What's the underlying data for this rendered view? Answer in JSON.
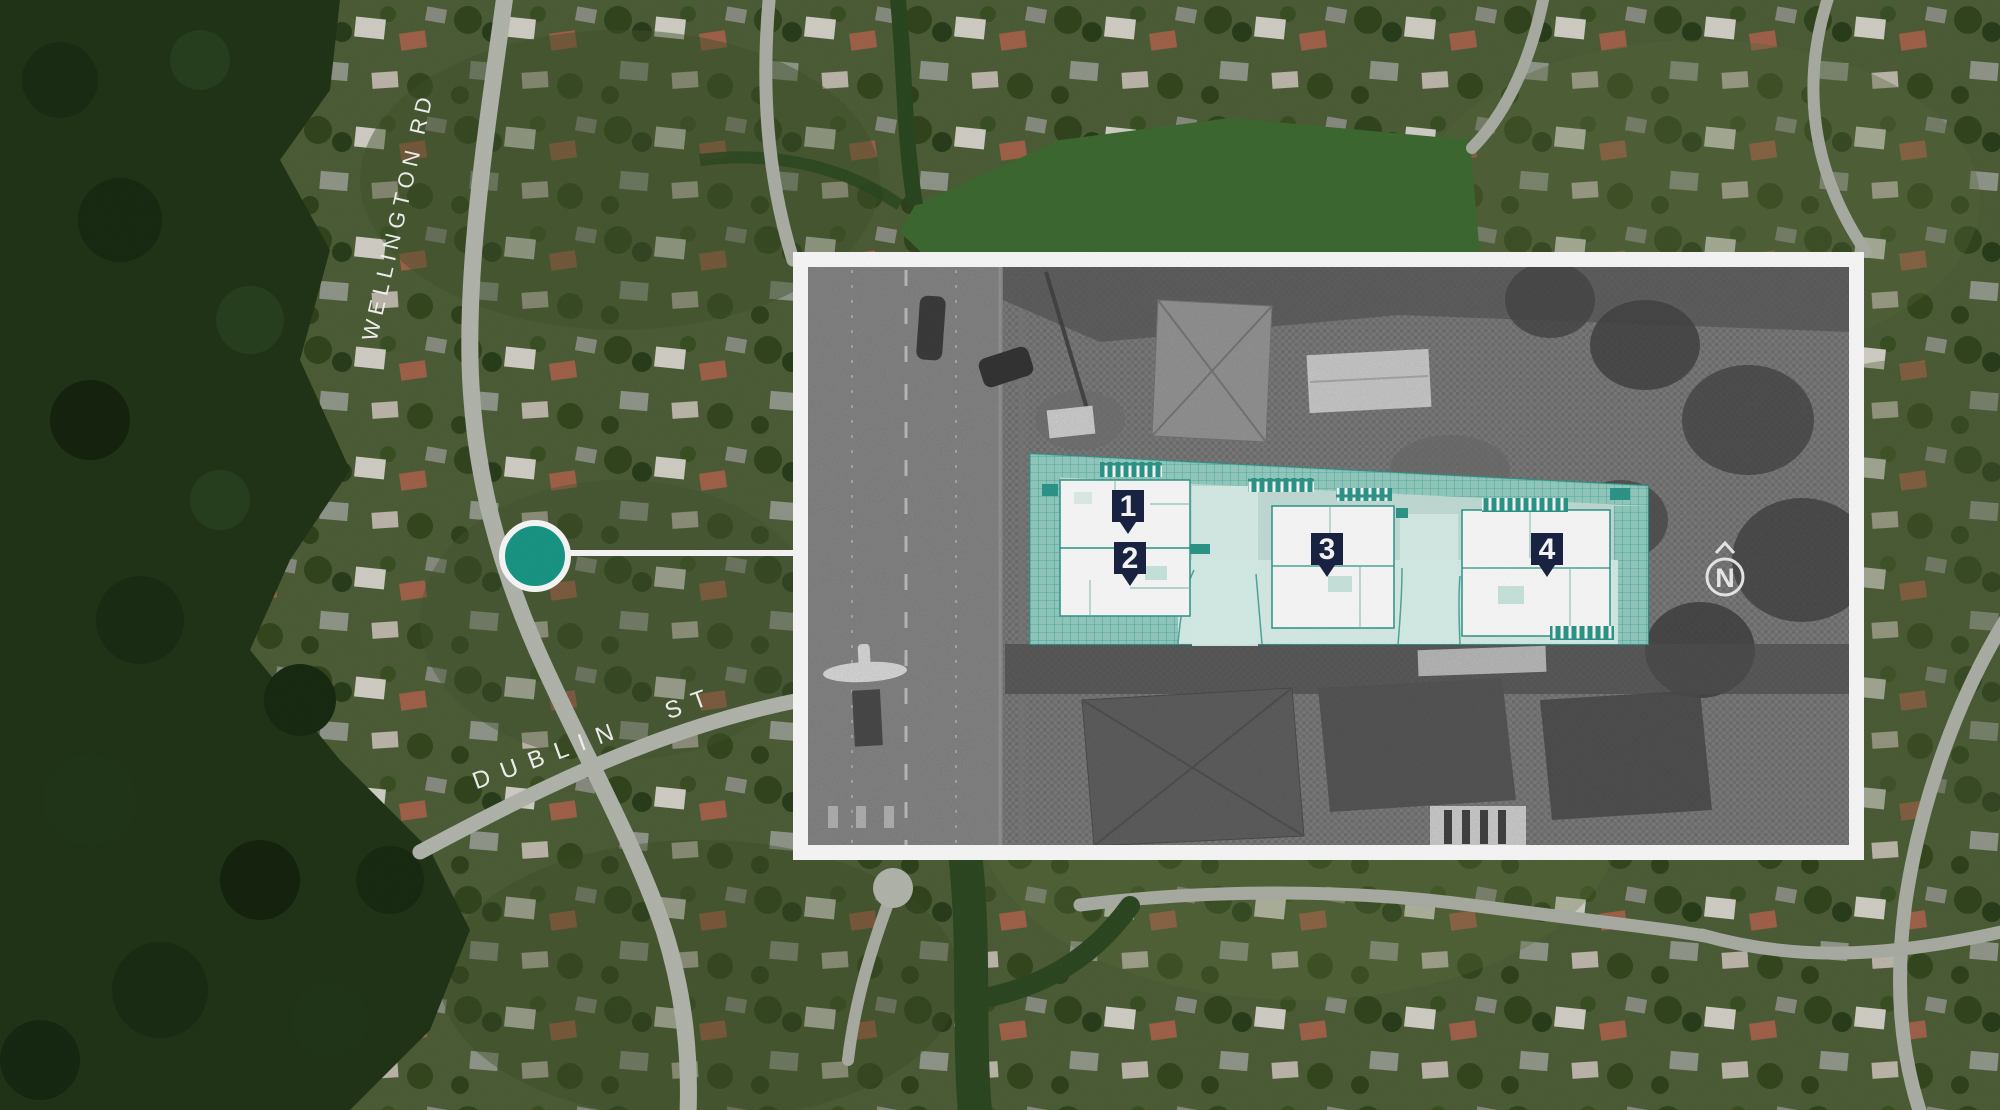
{
  "map": {
    "street_labels": [
      {
        "id": "wellington-rd",
        "label": "WELLINGTON RD"
      },
      {
        "id": "dublin-st",
        "label": "DUBLIN ST"
      }
    ],
    "location_marker": {
      "shape": "circle",
      "color": "#1A9A89"
    }
  },
  "inset": {
    "description": "black-and-white aerial photo with teal site-plan overlay",
    "units": [
      {
        "number": "1"
      },
      {
        "number": "2"
      },
      {
        "number": "3"
      },
      {
        "number": "4"
      }
    ],
    "compass": {
      "label": "N"
    }
  },
  "colors": {
    "accent_teal": "#1A9A89",
    "plan_teal": "#2E9A8C",
    "plan_mint": "#CDEAE3",
    "plan_hatch": "#93CEC2",
    "pin_navy": "#1B2444",
    "inset_border": "#FFFFFF",
    "forest_green": "#223619",
    "field_green": "#3F6C33"
  }
}
